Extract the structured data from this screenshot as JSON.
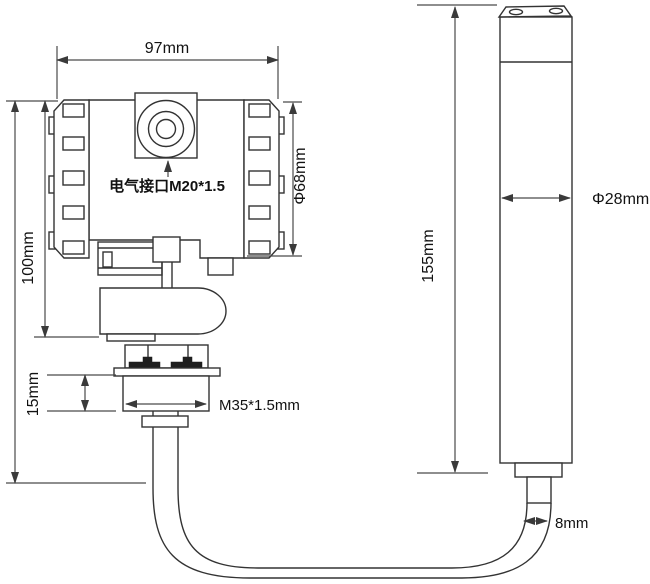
{
  "drawing": {
    "type": "technical-dimension-drawing",
    "background": "#ffffff",
    "line_color": "#333333",
    "dimension_line_color": "#4a4a4a",
    "text_color": "#121212",
    "transmitter": {
      "labels": {
        "top_width": "97mm",
        "left_height": "100mm",
        "flange_height": "15mm",
        "electrical_port": "电气接口M20*1.5",
        "housing_diameter": "Φ68mm",
        "process_thread": "M35*1.5mm"
      }
    },
    "probe": {
      "labels": {
        "length": "155mm",
        "diameter": "Φ28mm",
        "cable_diameter": "8mm"
      }
    }
  }
}
